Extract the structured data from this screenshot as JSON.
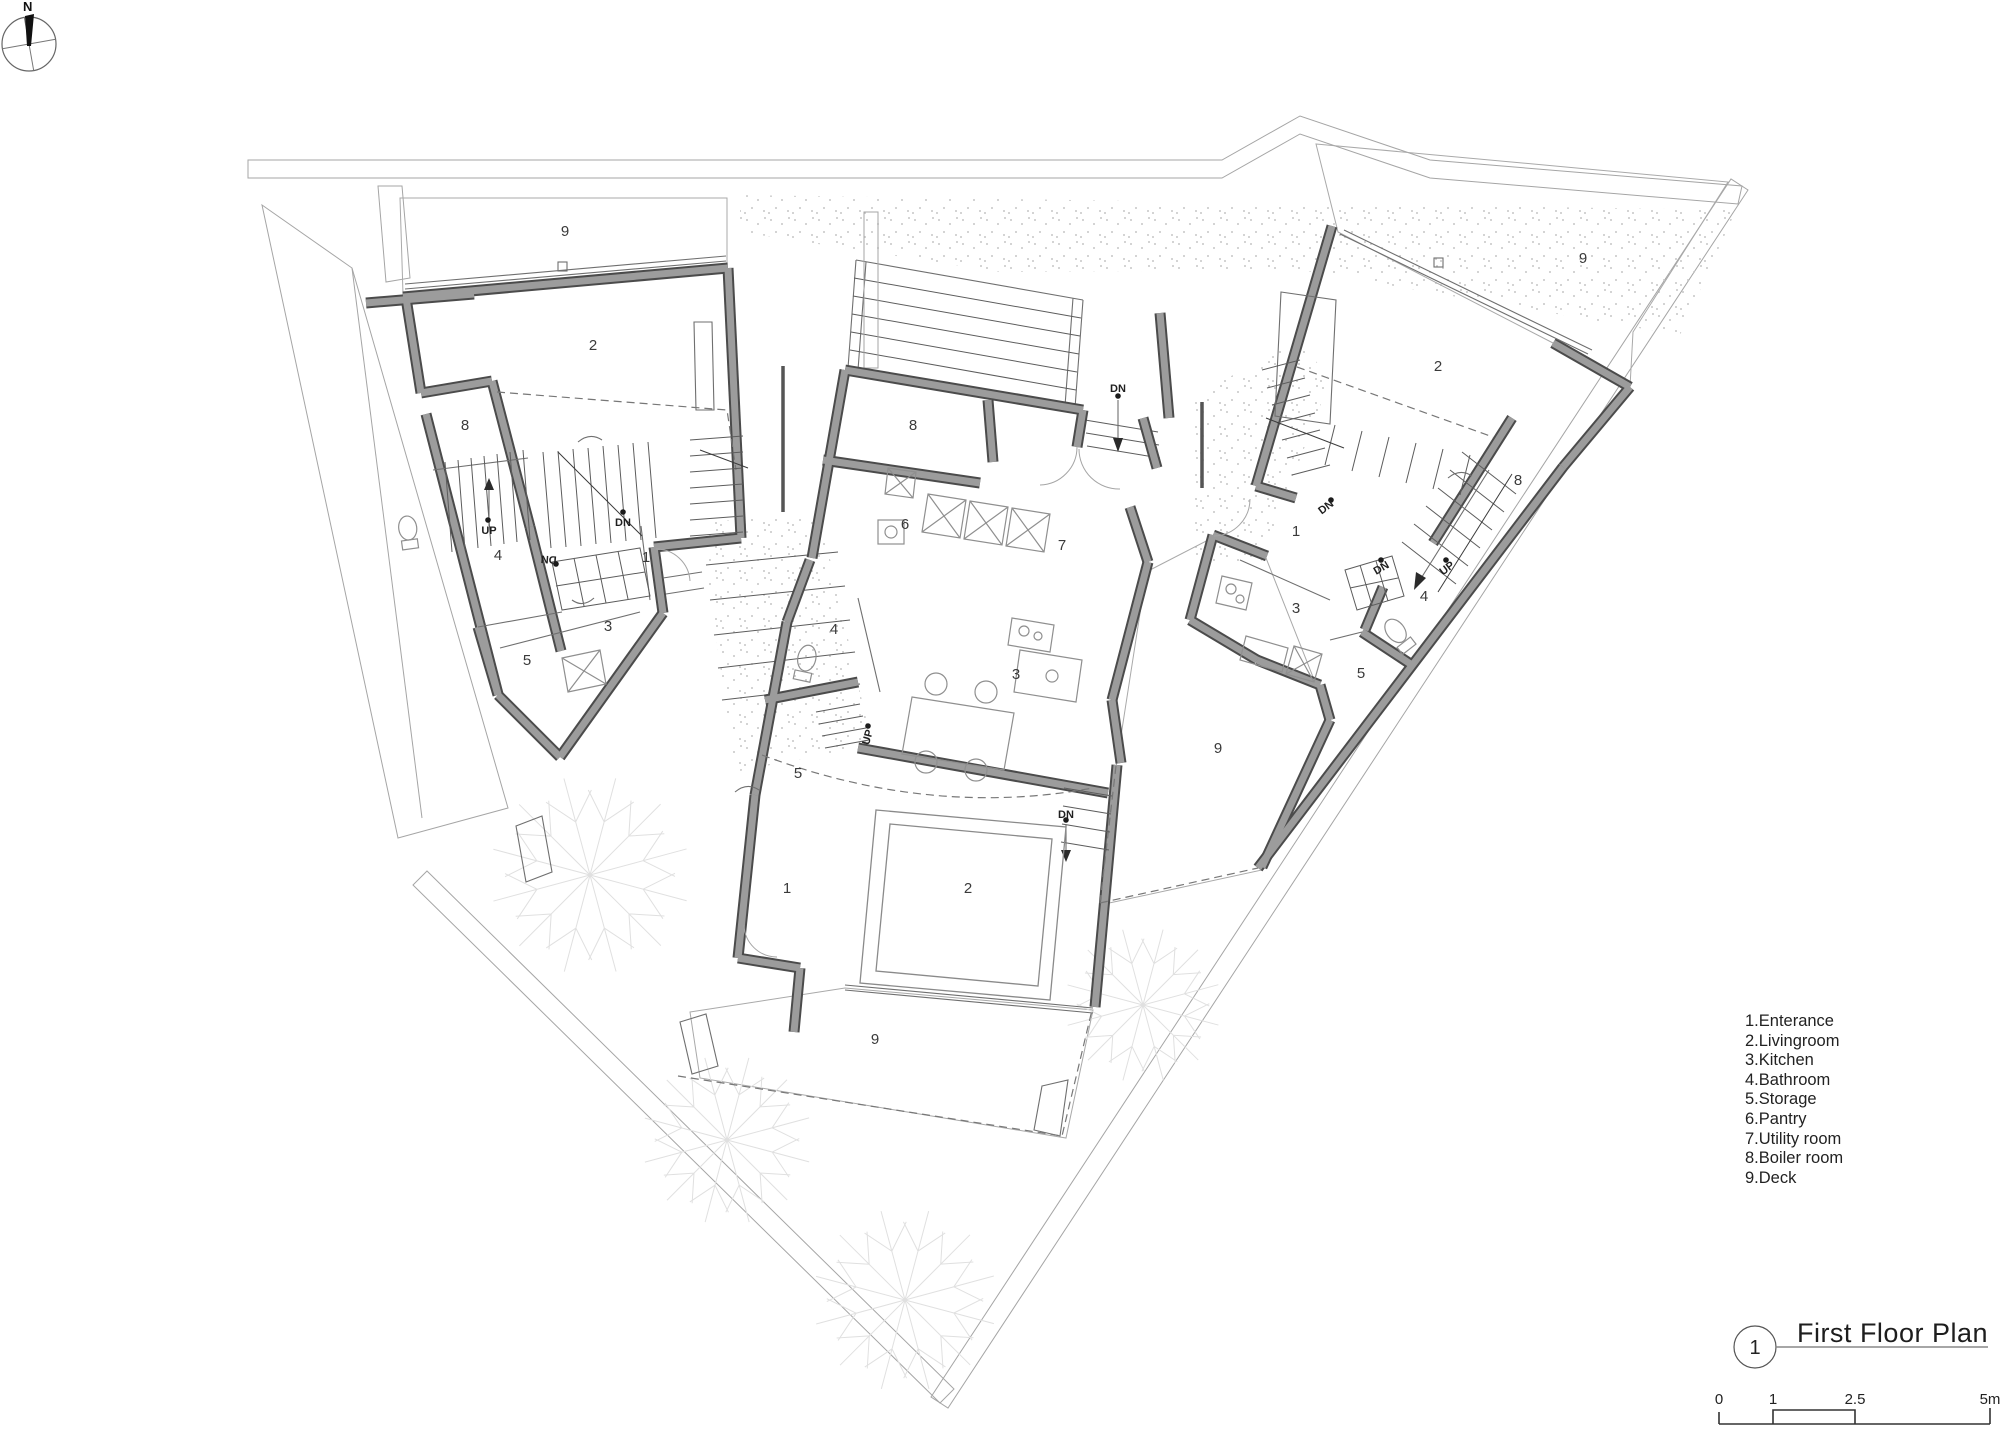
{
  "north": {
    "label": "N"
  },
  "legend": {
    "items": [
      "1.Enterance",
      "2.Livingroom",
      "3.Kitchen",
      "4.Bathroom",
      "5.Storage",
      "6.Pantry",
      "7.Utility room",
      "8.Boiler room",
      "9.Deck"
    ]
  },
  "titleblock": {
    "number": "1",
    "title": "First Floor Plan"
  },
  "scalebar": {
    "labels": [
      "0",
      "1",
      "2.5",
      "5m"
    ]
  },
  "plan": {
    "labels": [
      {
        "t": "9",
        "x": 565,
        "y": 236
      },
      {
        "t": "2",
        "x": 593,
        "y": 350
      },
      {
        "t": "8",
        "x": 465,
        "y": 430
      },
      {
        "t": "UP",
        "x": 489,
        "y": 534,
        "s": 11
      },
      {
        "t": "DN",
        "x": 623,
        "y": 526,
        "s": 11
      },
      {
        "t": "DN",
        "x": 549,
        "y": 556,
        "s": 11,
        "r": 184
      },
      {
        "t": "4",
        "x": 498,
        "y": 560
      },
      {
        "t": "1",
        "x": 646,
        "y": 562
      },
      {
        "t": "3",
        "x": 608,
        "y": 631
      },
      {
        "t": "5",
        "x": 527,
        "y": 665
      },
      {
        "t": "8",
        "x": 913,
        "y": 430
      },
      {
        "t": "DN",
        "x": 1118,
        "y": 392,
        "s": 11
      },
      {
        "t": "6",
        "x": 905,
        "y": 529
      },
      {
        "t": "7",
        "x": 1062,
        "y": 550
      },
      {
        "t": "4",
        "x": 834,
        "y": 634
      },
      {
        "t": "3",
        "x": 1016,
        "y": 679
      },
      {
        "t": "5",
        "x": 798,
        "y": 778
      },
      {
        "t": "UP",
        "x": 871,
        "y": 738,
        "s": 11,
        "r": -75
      },
      {
        "t": "1",
        "x": 787,
        "y": 893
      },
      {
        "t": "2",
        "x": 968,
        "y": 893
      },
      {
        "t": "DN",
        "x": 1066,
        "y": 818,
        "s": 11
      },
      {
        "t": "9",
        "x": 875,
        "y": 1044
      },
      {
        "t": "9",
        "x": 1218,
        "y": 753
      },
      {
        "t": "2",
        "x": 1438,
        "y": 371
      },
      {
        "t": "9",
        "x": 1583,
        "y": 263
      },
      {
        "t": "8",
        "x": 1518,
        "y": 485
      },
      {
        "t": "1",
        "x": 1296,
        "y": 536
      },
      {
        "t": "DN",
        "x": 1328,
        "y": 510,
        "s": 11,
        "r": -37
      },
      {
        "t": "UP",
        "x": 1449,
        "y": 571,
        "s": 11,
        "r": -37
      },
      {
        "t": "DN",
        "x": 1383,
        "y": 571,
        "s": 11,
        "r": -30
      },
      {
        "t": "4",
        "x": 1424,
        "y": 601
      },
      {
        "t": "3",
        "x": 1296,
        "y": 613
      },
      {
        "t": "5",
        "x": 1361,
        "y": 678
      }
    ]
  }
}
